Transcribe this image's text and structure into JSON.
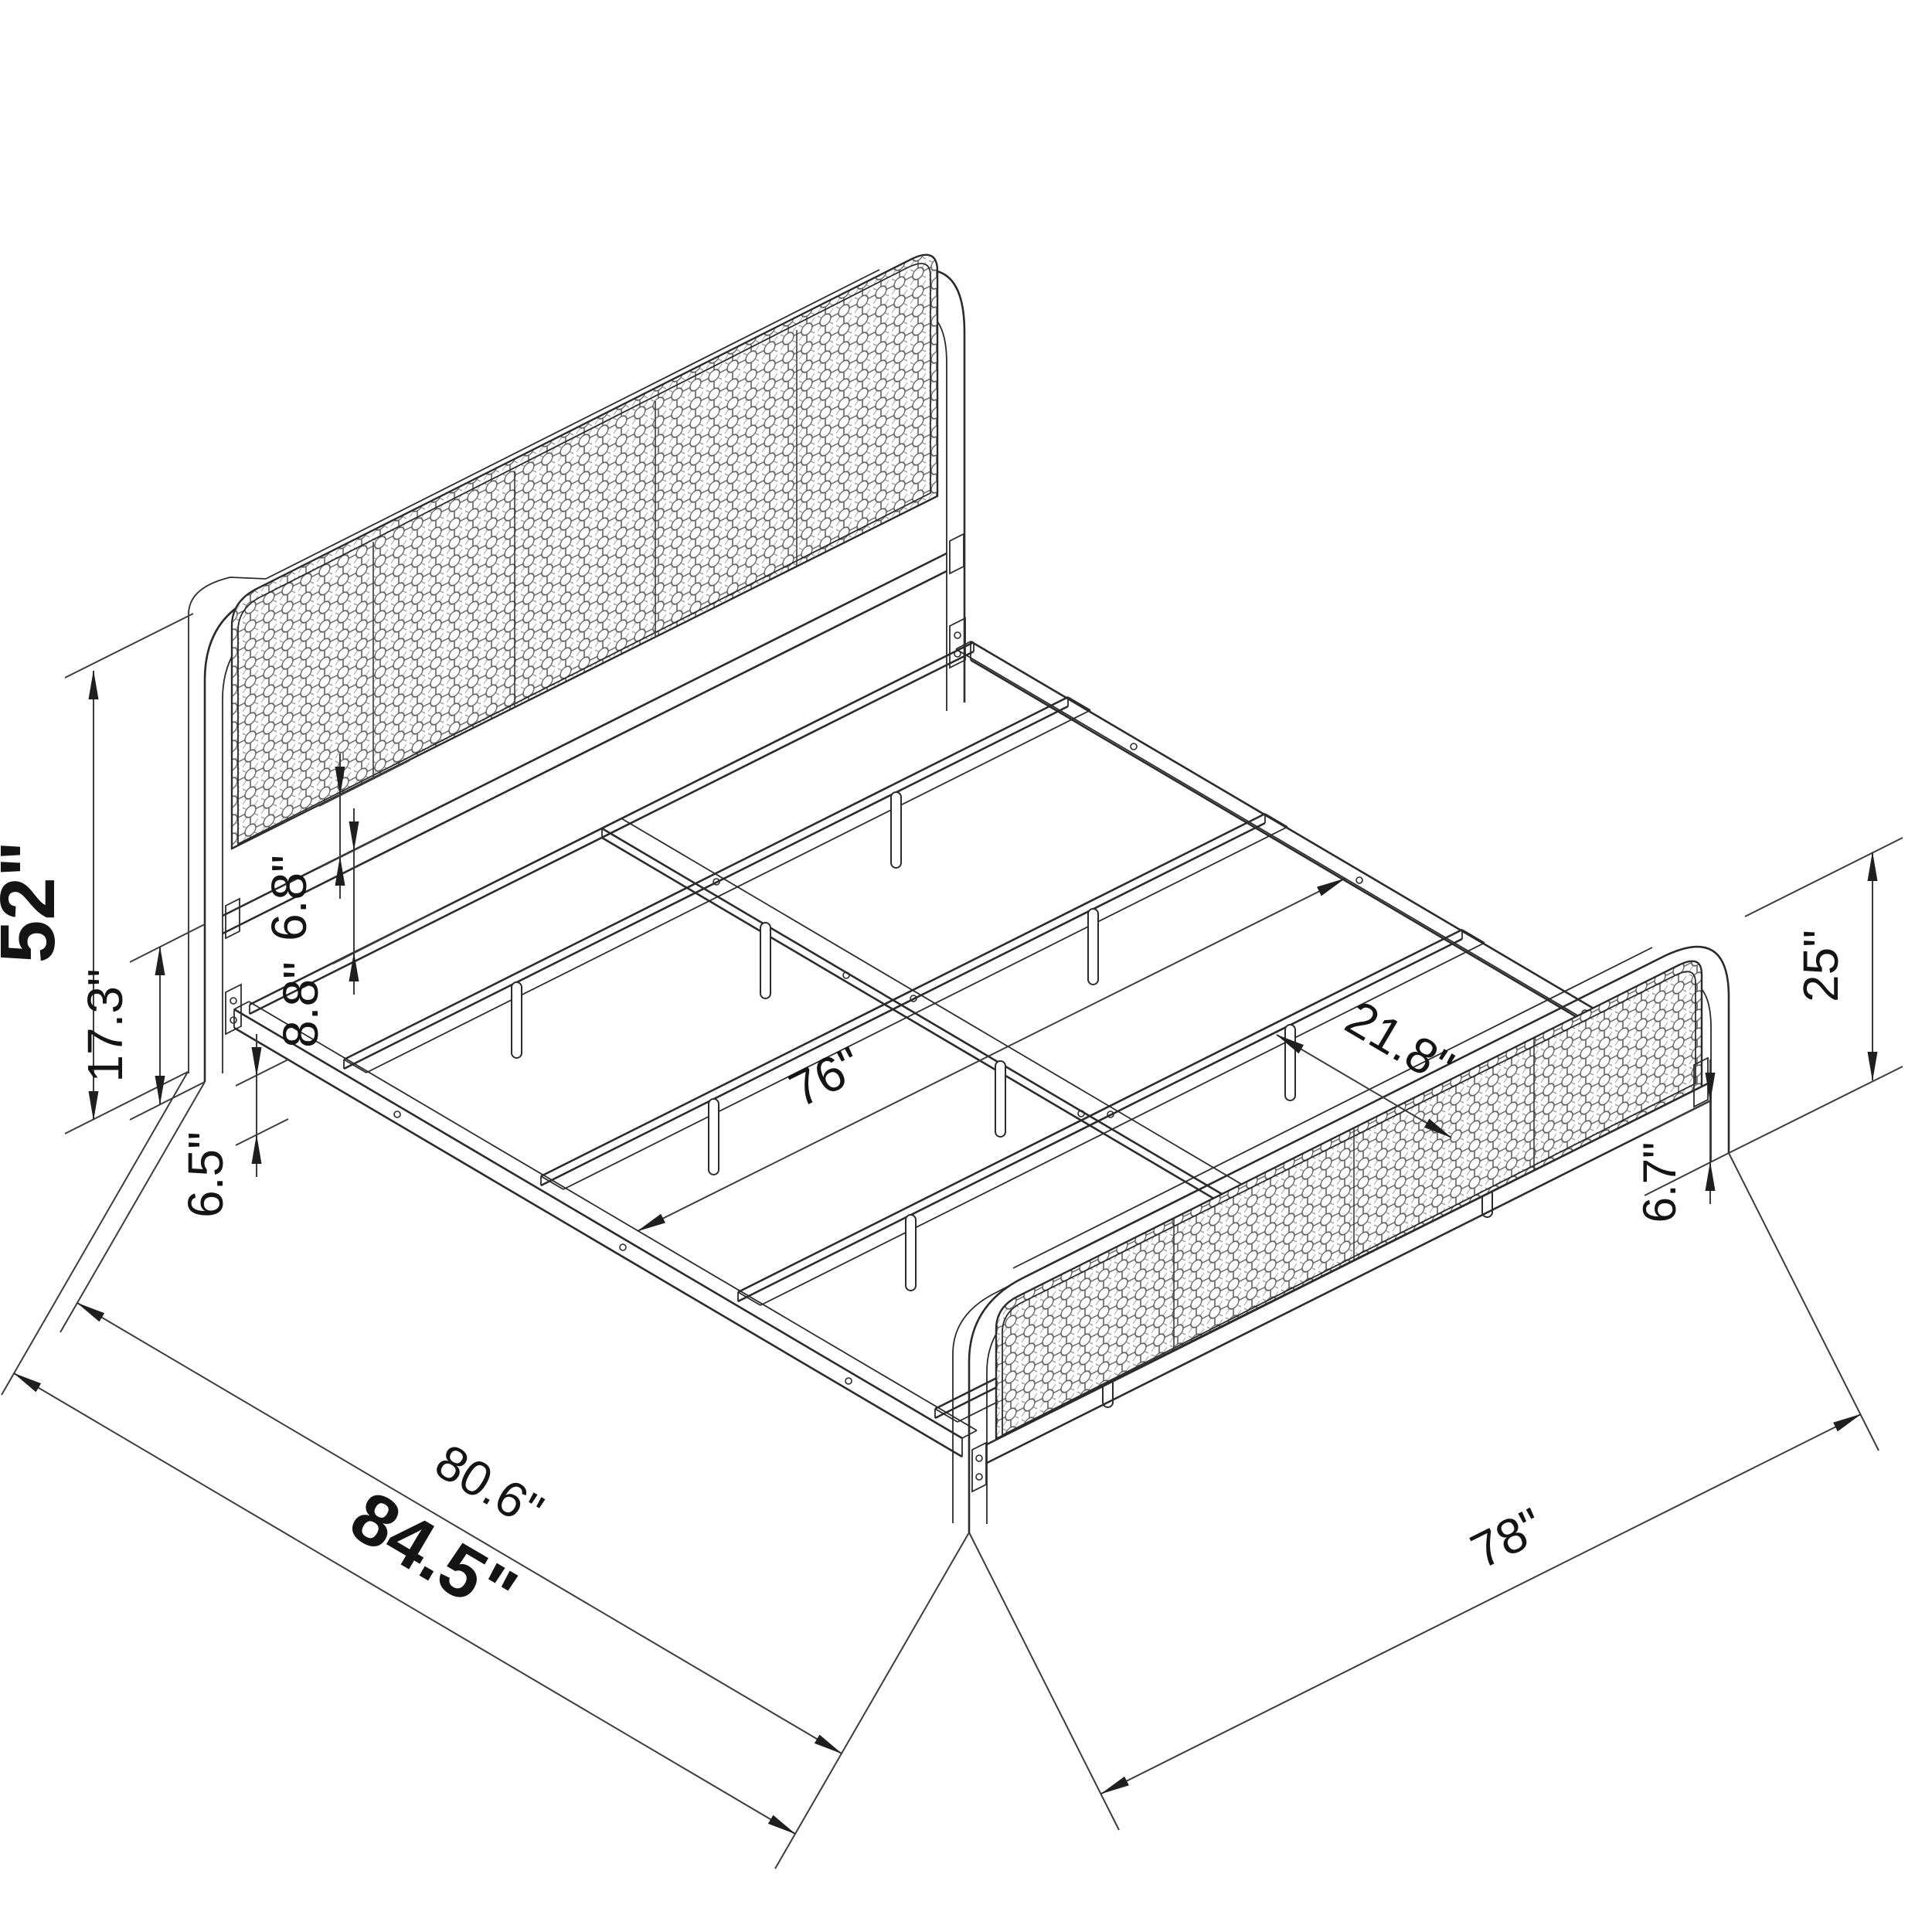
{
  "drawing": {
    "type": "isometric-furniture-dimension-diagram",
    "subject": "metal platform bed frame with cane headboard and footboard",
    "background": "#ffffff",
    "line_color": "#2b2b2b",
    "text_color": "#141414"
  },
  "dimensions": {
    "headboard_height": "52\"",
    "headboard_base_height": "17.3\"",
    "headboard_panel_gap": "6.8\"",
    "crossbar_to_rail": "8.8\"",
    "side_rail_clearance": "6.5\"",
    "inner_width": "76\"",
    "slat_spacing": "21.8\"",
    "frame_length": "80.6\"",
    "overall_length": "84.5\"",
    "footboard_width": "78\"",
    "footboard_height": "25\"",
    "footboard_clearance": "6.7\""
  }
}
